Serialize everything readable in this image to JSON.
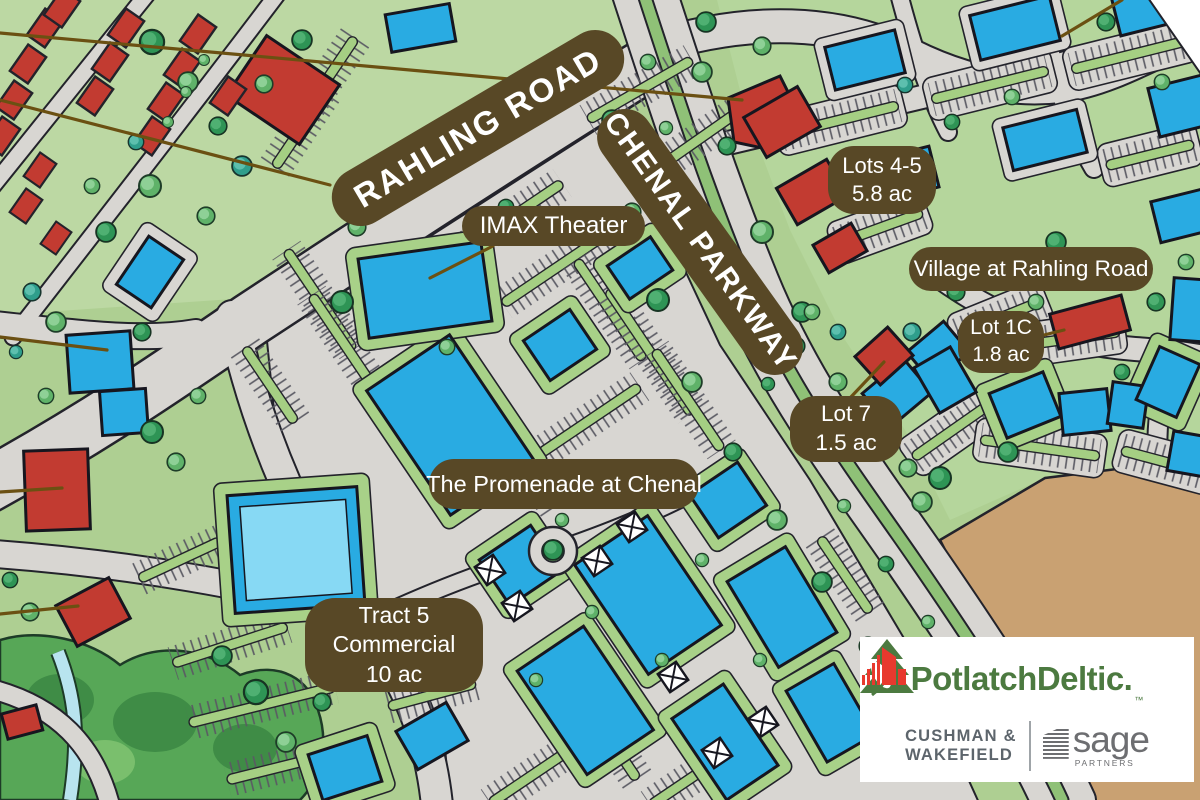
{
  "map": {
    "road_labels": {
      "rahling": "RAHLING ROAD",
      "chenal": "CHENAL PARKWAY"
    },
    "place_labels": {
      "imax": {
        "line1": "IMAX Theater"
      },
      "lots45": {
        "line1": "Lots 4-5",
        "line2": "5.8 ac"
      },
      "village": {
        "line1": "Village at Rahling Road"
      },
      "lot1c": {
        "line1": "Lot 1C",
        "line2": "1.8 ac"
      },
      "lot7": {
        "line1": "Lot 7",
        "line2": "1.5 ac"
      },
      "promenade": {
        "line1": "The Promenade at Chenal"
      },
      "tract5": {
        "line1": "Tract 5",
        "line2": "Commercial",
        "line3": "10 ac"
      }
    },
    "palette": {
      "label_pill_brown": "#584826",
      "leader_line_brown": "#6b5012",
      "base_green": "#aecf92",
      "road_gray": "#d8d6d2",
      "building_blue": "#29abe2",
      "building_red": "#c23b31",
      "undeveloped_tan": "#c9a172",
      "outline_dark": "#23232b"
    }
  },
  "branding": {
    "potlatchdeltic": {
      "wordmark": "PotlatchDeltic.",
      "trademark": "™",
      "green": "#4c7a40"
    },
    "cushman_wakefield": {
      "line1": "CUSHMAN &",
      "line2": "WAKEFIELD",
      "red": "#e8392e",
      "gray": "#5d656c"
    },
    "sage": {
      "wordmark": "sage",
      "subtext": "PARTNERS",
      "gray": "#6d6e71"
    }
  }
}
